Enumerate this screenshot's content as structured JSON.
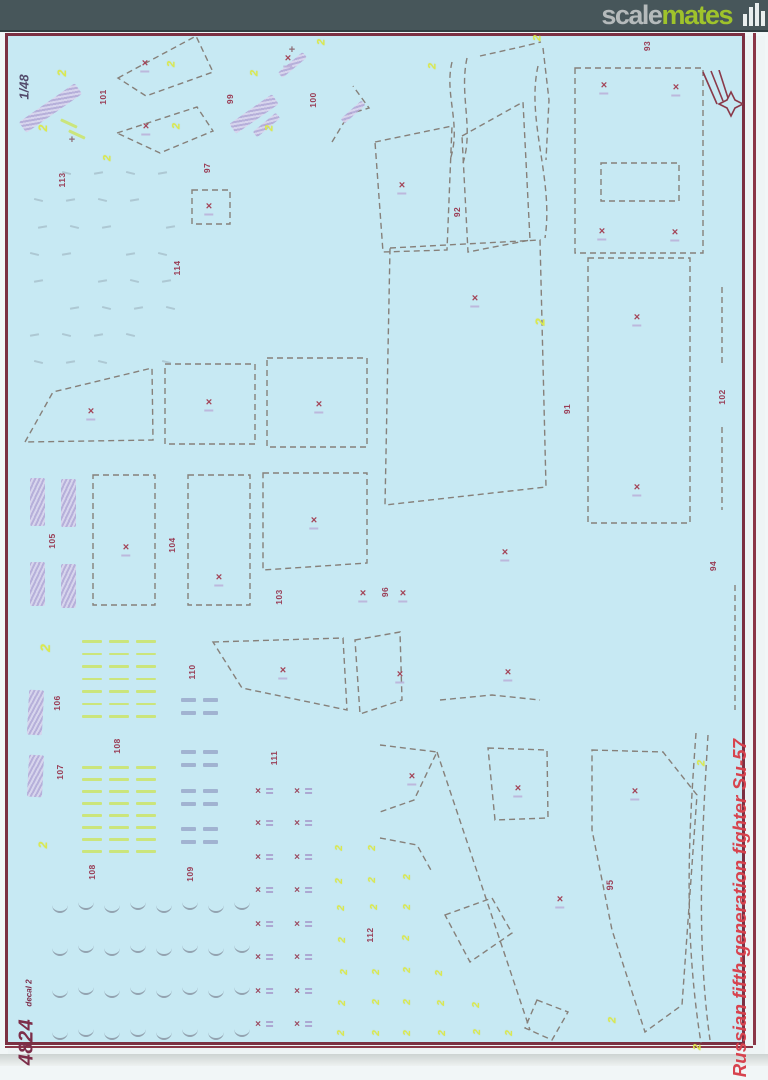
{
  "header": {
    "logo_scale": "scale",
    "logo_mates": "mates",
    "logo_icon": "bar-chart-icon",
    "bar_color": "#47565a",
    "scale_color": "#b5babb",
    "mates_color": "#9fc32b"
  },
  "sheet": {
    "scale_label": "1/48",
    "product_code": "4824",
    "product_sub": "decal 2",
    "side_title": "Russian fifth-generation fighter Su-57",
    "colors": {
      "paper_blue": "#c7e9f3",
      "frame_maroon": "#7b3042",
      "dash_gray": "#86807a",
      "number_maroon": "#993d55",
      "accent_yellow": "#dbe94f",
      "lilac": "#b4a9d7",
      "stripe_green": "#cbe57c",
      "title_red": "#d7434e"
    },
    "part_labels": [
      [
        "101",
        103,
        97
      ],
      [
        "113",
        62,
        180
      ],
      [
        "99",
        230,
        99
      ],
      [
        "97",
        207,
        168
      ],
      [
        "114",
        177,
        268
      ],
      [
        "100",
        313,
        100
      ],
      [
        "92",
        457,
        212
      ],
      [
        "93",
        647,
        46
      ],
      [
        "91",
        567,
        409
      ],
      [
        "102",
        722,
        397
      ],
      [
        "96",
        385,
        592
      ],
      [
        "94",
        713,
        566
      ],
      [
        "103",
        279,
        597
      ],
      [
        "105",
        52,
        541
      ],
      [
        "104",
        172,
        545
      ],
      [
        "106",
        57,
        703
      ],
      [
        "108",
        117,
        746
      ],
      [
        "107",
        60,
        772
      ],
      [
        "110",
        192,
        672
      ],
      [
        "111",
        274,
        758
      ],
      [
        "108",
        92,
        872
      ],
      [
        "109",
        190,
        874
      ],
      [
        "112",
        370,
        935
      ],
      [
        "95",
        610,
        885
      ]
    ],
    "x_marks": [
      [
        145,
        64
      ],
      [
        146,
        127
      ],
      [
        209,
        207
      ],
      [
        288,
        59
      ],
      [
        402,
        186
      ],
      [
        475,
        299
      ],
      [
        604,
        86
      ],
      [
        676,
        88
      ],
      [
        602,
        232
      ],
      [
        675,
        233
      ],
      [
        637,
        318
      ],
      [
        637,
        488
      ],
      [
        91,
        412
      ],
      [
        209,
        403
      ],
      [
        319,
        405
      ],
      [
        126,
        548
      ],
      [
        219,
        578
      ],
      [
        314,
        521
      ],
      [
        363,
        594
      ],
      [
        403,
        594
      ],
      [
        505,
        553
      ],
      [
        400,
        675
      ],
      [
        508,
        673
      ],
      [
        283,
        671
      ],
      [
        412,
        777
      ],
      [
        518,
        789
      ],
      [
        635,
        792
      ],
      [
        560,
        900
      ]
    ],
    "x_col_marks": [
      [
        258,
        792
      ],
      [
        297,
        792
      ],
      [
        258,
        824
      ],
      [
        297,
        824
      ],
      [
        258,
        858
      ],
      [
        297,
        858
      ],
      [
        258,
        891
      ],
      [
        297,
        891
      ],
      [
        258,
        925
      ],
      [
        297,
        925
      ],
      [
        258,
        958
      ],
      [
        297,
        958
      ],
      [
        258,
        992
      ],
      [
        297,
        992
      ],
      [
        258,
        1025
      ],
      [
        297,
        1025
      ]
    ],
    "yellow_twos": [
      [
        62,
        73,
        12
      ],
      [
        43,
        128,
        12
      ],
      [
        108,
        158,
        11
      ],
      [
        172,
        64,
        11
      ],
      [
        177,
        126,
        11
      ],
      [
        255,
        73,
        11
      ],
      [
        270,
        128,
        11
      ],
      [
        322,
        42,
        11
      ],
      [
        433,
        66,
        11
      ],
      [
        538,
        38,
        11
      ],
      [
        540,
        322,
        13
      ],
      [
        45,
        648,
        14
      ],
      [
        43,
        845,
        12
      ],
      [
        702,
        763,
        11
      ],
      [
        613,
        1020,
        11
      ],
      [
        698,
        1047,
        11
      ],
      [
        340,
        848,
        10
      ],
      [
        373,
        848,
        10
      ],
      [
        340,
        881,
        10
      ],
      [
        373,
        880,
        10
      ],
      [
        408,
        877,
        10
      ],
      [
        342,
        908,
        10
      ],
      [
        375,
        907,
        10
      ],
      [
        408,
        907,
        10
      ],
      [
        343,
        940,
        10
      ],
      [
        407,
        938,
        10
      ],
      [
        345,
        972,
        10
      ],
      [
        377,
        972,
        10
      ],
      [
        408,
        970,
        10
      ],
      [
        440,
        973,
        10
      ],
      [
        343,
        1003,
        10
      ],
      [
        377,
        1002,
        10
      ],
      [
        408,
        1002,
        10
      ],
      [
        442,
        1003,
        10
      ],
      [
        477,
        1005,
        10
      ],
      [
        342,
        1033,
        10
      ],
      [
        377,
        1033,
        10
      ],
      [
        408,
        1033,
        10
      ],
      [
        443,
        1033,
        10
      ],
      [
        478,
        1032,
        10
      ],
      [
        510,
        1033,
        10
      ]
    ],
    "lilac_patches": [
      [
        50,
        108,
        13,
        68,
        55
      ],
      [
        254,
        114,
        12,
        52,
        55
      ],
      [
        37,
        502,
        15,
        48,
        0
      ],
      [
        68,
        503,
        15,
        48,
        0
      ],
      [
        37,
        584,
        15,
        44,
        0
      ],
      [
        68,
        586,
        15,
        44,
        0
      ],
      [
        35,
        712,
        15,
        45,
        3
      ],
      [
        35,
        776,
        15,
        42,
        3
      ],
      [
        292,
        65,
        7,
        32,
        50
      ],
      [
        266,
        125,
        7,
        30,
        50
      ],
      [
        353,
        112,
        6,
        28,
        48
      ]
    ],
    "green_clusters": [
      {
        "x": 82,
        "y": 640,
        "rows": 7,
        "step": 12.5,
        "cols": 3,
        "w": 20,
        "gap": 7
      },
      {
        "x": 82,
        "y": 766,
        "rows": 8,
        "step": 12,
        "cols": 3,
        "w": 20,
        "gap": 7
      }
    ],
    "green_strays": [
      [
        60,
        122,
        18,
        25
      ],
      [
        68,
        133,
        18,
        25
      ]
    ],
    "tick_grid": {
      "rows": [
        905,
        948,
        990,
        1032
      ],
      "col_start": 52,
      "col_step": 26,
      "col_count": 8
    },
    "micro_grid": {
      "row_start": 172,
      "row_step": 27,
      "row_count": 8,
      "col_start": 30,
      "col_step": 32,
      "col_count": 5
    },
    "blue_pairs": {
      "cols": [
        181,
        203
      ],
      "rows": [
        698,
        711,
        750,
        763,
        789,
        802,
        827,
        840
      ]
    },
    "plus_marks": [
      [
        72,
        140
      ],
      [
        292,
        50
      ]
    ]
  }
}
